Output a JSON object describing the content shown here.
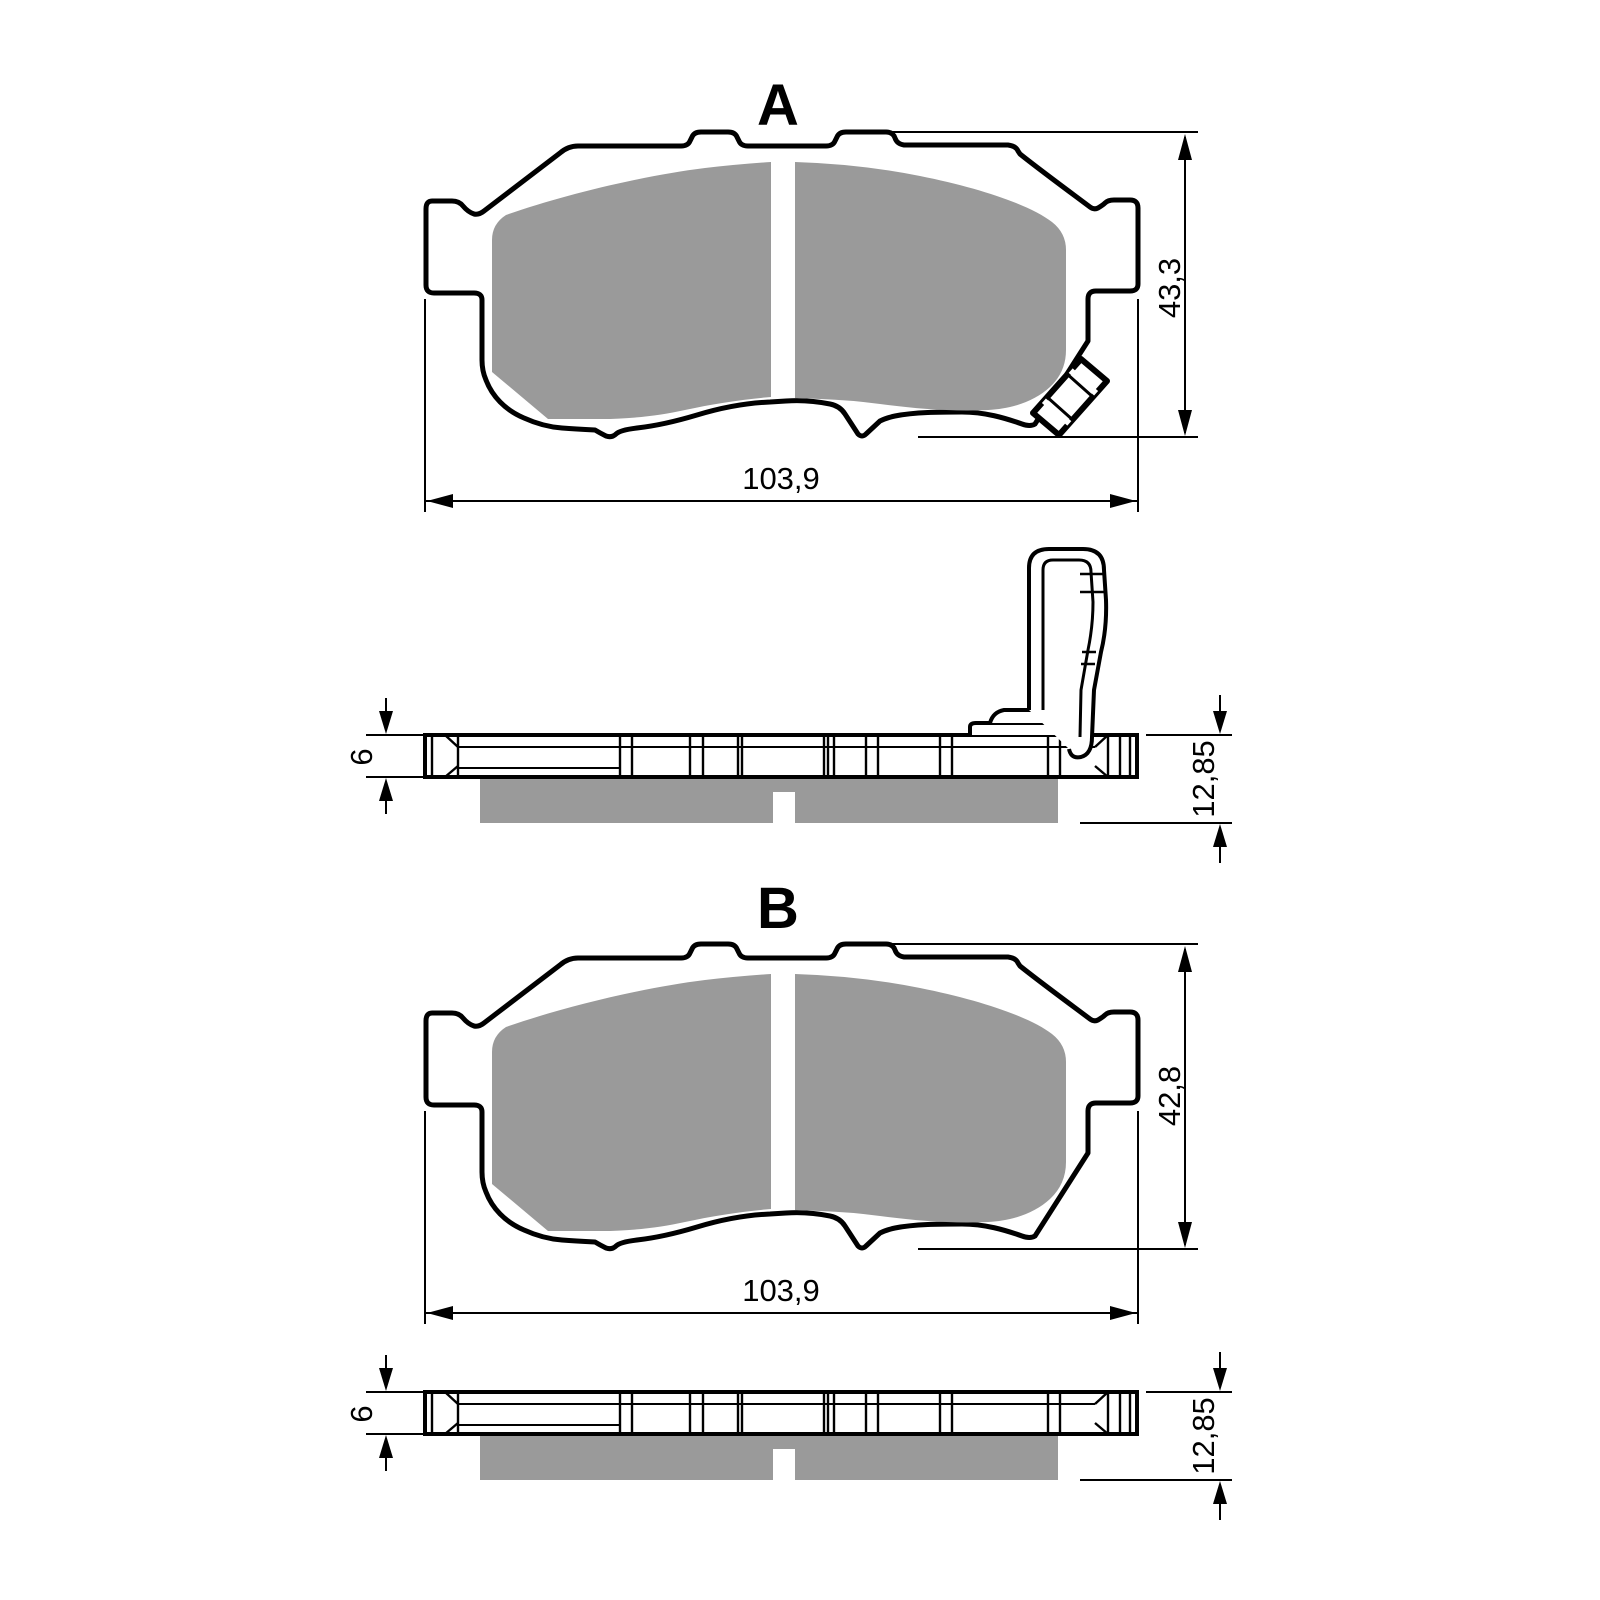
{
  "diagram": {
    "type": "technical-drawing-brake-pads",
    "colors": {
      "line": "#000000",
      "friction_material": "#9a9a9a",
      "background": "#ffffff"
    },
    "view_a": {
      "label": "A",
      "height_mm": "43,3",
      "width_mm": "103,9",
      "backplate_thickness_mm": "6",
      "total_thickness_mm": "12,85"
    },
    "view_b": {
      "label": "B",
      "height_mm": "42,8",
      "width_mm": "103,9",
      "backplate_thickness_mm": "6",
      "total_thickness_mm": "12,85"
    }
  }
}
